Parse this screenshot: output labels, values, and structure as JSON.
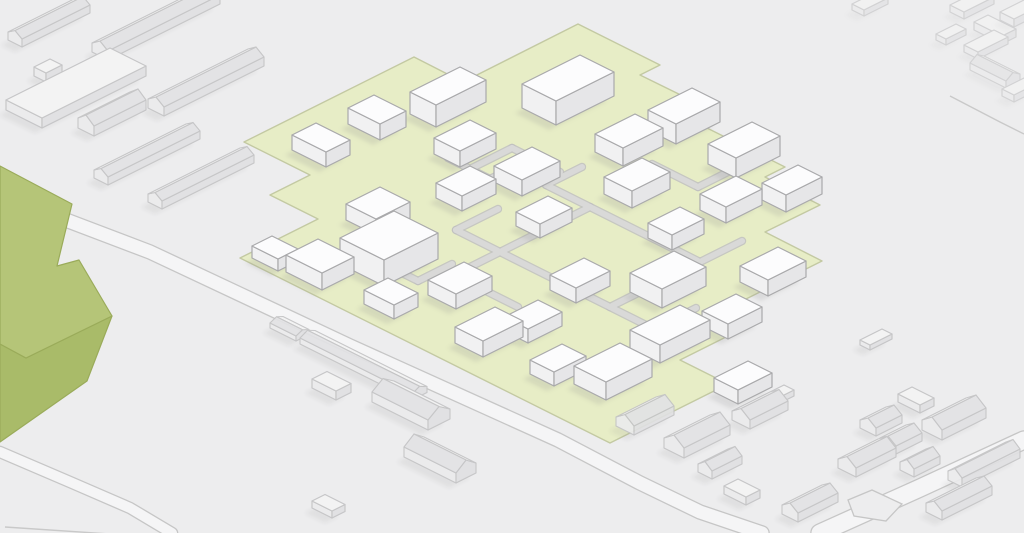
{
  "scene": {
    "width": 1024,
    "height": 533,
    "background": "#ededee",
    "description": "Isometric site-plan illustration: white buildings on a green development site surrounded by faded context buildings and roads"
  },
  "palette": {
    "site_building": {
      "top": "#fcfcfd",
      "left": "#f1f1f2",
      "right": "#e6e6e8",
      "stroke": "#a9a9ab",
      "shadow_opacity": 0.2
    },
    "context_building": {
      "top": "#f4f4f4",
      "left": "#ebebec",
      "right": "#e0e0e2",
      "roof_light": "#f2f2f2",
      "roof_dark": "#e2e2e4",
      "stroke": "#c2c2c4",
      "shadow_opacity": 0.14
    },
    "site_green": {
      "fill": "#e7edc6",
      "stroke": "#c3c9a2"
    },
    "footpath": {
      "casing": "#bfbfbf",
      "fill": "#d9d9d8"
    },
    "road": {
      "casing": "#c6c6c6",
      "fill": "#f5f5f6",
      "thin_line": "#c9c9c9"
    },
    "landmark": {
      "top": "#b5c578",
      "front": "#a9bb69",
      "stroke": "#9aab5a"
    },
    "shadow": "#8f8f8f"
  },
  "site": {
    "outline": [
      [
        578,
        24
      ],
      [
        660,
        65
      ],
      [
        640,
        75
      ],
      [
        695,
        102
      ],
      [
        675,
        112
      ],
      [
        785,
        167
      ],
      [
        765,
        177
      ],
      [
        820,
        205
      ],
      [
        765,
        232
      ],
      [
        822,
        261
      ],
      [
        732,
        306
      ],
      [
        760,
        320
      ],
      [
        680,
        360
      ],
      [
        728,
        384
      ],
      [
        658,
        419
      ],
      [
        610,
        443
      ],
      [
        240,
        258
      ],
      [
        318,
        219
      ],
      [
        270,
        195
      ],
      [
        310,
        175
      ],
      [
        244,
        142
      ],
      [
        414,
        57
      ],
      [
        463,
        82
      ]
    ],
    "buildings": [
      [
        292,
        150,
        34,
        24,
        15
      ],
      [
        348,
        124,
        32,
        26,
        16
      ],
      [
        410,
        114,
        26,
        50,
        22
      ],
      [
        522,
        108,
        34,
        58,
        24
      ],
      [
        595,
        152,
        28,
        40,
        18
      ],
      [
        648,
        130,
        28,
        44,
        20
      ],
      [
        708,
        164,
        28,
        44,
        20
      ],
      [
        762,
        200,
        24,
        36,
        17
      ],
      [
        434,
        154,
        26,
        36,
        16
      ],
      [
        436,
        198,
        26,
        34,
        15
      ],
      [
        494,
        182,
        28,
        38,
        16
      ],
      [
        516,
        226,
        24,
        32,
        14
      ],
      [
        604,
        194,
        28,
        38,
        17
      ],
      [
        648,
        238,
        24,
        32,
        15
      ],
      [
        700,
        210,
        26,
        36,
        16
      ],
      [
        740,
        282,
        28,
        38,
        16
      ],
      [
        702,
        326,
        26,
        34,
        15
      ],
      [
        346,
        220,
        30,
        34,
        16
      ],
      [
        340,
        264,
        44,
        54,
        26
      ],
      [
        286,
        272,
        36,
        32,
        17
      ],
      [
        252,
        258,
        26,
        20,
        12
      ],
      [
        428,
        295,
        28,
        36,
        15
      ],
      [
        364,
        304,
        30,
        24,
        14
      ],
      [
        455,
        343,
        28,
        40,
        16
      ],
      [
        504,
        331,
        24,
        34,
        14
      ],
      [
        530,
        374,
        24,
        32,
        14
      ],
      [
        574,
        384,
        32,
        46,
        18
      ],
      [
        550,
        290,
        26,
        34,
        15
      ],
      [
        630,
        292,
        32,
        44,
        19
      ],
      [
        630,
        348,
        30,
        50,
        18
      ],
      [
        714,
        392,
        24,
        34,
        14
      ]
    ],
    "footpaths": [
      [
        [
          500,
          252
        ],
        [
          590,
          207
        ]
      ],
      [
        [
          590,
          207
        ],
        [
          700,
          262
        ]
      ],
      [
        [
          700,
          262
        ],
        [
          610,
          307
        ]
      ],
      [
        [
          610,
          307
        ],
        [
          500,
          252
        ]
      ],
      [
        [
          590,
          207
        ],
        [
          546,
          185
        ]
      ],
      [
        [
          546,
          185
        ],
        [
          582,
          167
        ]
      ],
      [
        [
          700,
          262
        ],
        [
          742,
          241
        ]
      ],
      [
        [
          610,
          307
        ],
        [
          654,
          329
        ]
      ],
      [
        [
          500,
          252
        ],
        [
          456,
          230
        ]
      ],
      [
        [
          456,
          230
        ],
        [
          498,
          209
        ]
      ],
      [
        [
          500,
          252
        ],
        [
          454,
          275
        ]
      ],
      [
        [
          454,
          275
        ],
        [
          518,
          307
        ]
      ],
      [
        [
          448,
          158
        ],
        [
          490,
          179
        ]
      ],
      [
        [
          490,
          179
        ],
        [
          532,
          158
        ]
      ],
      [
        [
          532,
          158
        ],
        [
          512,
          148
        ]
      ],
      [
        [
          512,
          148
        ],
        [
          468,
          170
        ]
      ],
      [
        [
          532,
          158
        ],
        [
          560,
          172
        ]
      ],
      [
        [
          652,
          164
        ],
        [
          698,
          187
        ]
      ],
      [
        [
          698,
          187
        ],
        [
          740,
          166
        ]
      ],
      [
        [
          380,
          262
        ],
        [
          418,
          281
        ]
      ],
      [
        [
          418,
          281
        ],
        [
          452,
          264
        ]
      ],
      [
        [
          654,
          329
        ],
        [
          696,
          308
        ]
      ]
    ]
  },
  "landmark": {
    "top": [
      [
        0,
        166
      ],
      [
        72,
        204
      ],
      [
        57,
        266
      ],
      [
        79,
        260
      ],
      [
        112,
        316
      ],
      [
        26,
        358
      ],
      [
        0,
        344
      ]
    ],
    "front": [
      [
        0,
        344
      ],
      [
        26,
        358
      ],
      [
        112,
        316
      ],
      [
        87,
        381
      ],
      [
        0,
        442
      ]
    ]
  },
  "context_buildings": [
    [
      "g",
      "b",
      8,
      40,
      14,
      68,
      8,
      5
    ],
    [
      "b",
      "-",
      6,
      110,
      36,
      104,
      10,
      0
    ],
    [
      "g",
      "b",
      78,
      128,
      16,
      52,
      10,
      7
    ],
    [
      "b",
      "-",
      34,
      76,
      12,
      16,
      9,
      0
    ],
    [
      "g",
      "b",
      92,
      52,
      16,
      112,
      9,
      6
    ],
    [
      "g",
      "b",
      148,
      108,
      16,
      100,
      9,
      6
    ],
    [
      "g",
      "b",
      94,
      178,
      14,
      92,
      8,
      5
    ],
    [
      "g",
      "b",
      148,
      202,
      14,
      92,
      8,
      5
    ],
    [
      "g",
      "a",
      300,
      344,
      112,
      15,
      6,
      4
    ],
    [
      "g",
      "a",
      270,
      328,
      26,
      13,
      5,
      3
    ],
    [
      "b",
      "-",
      312,
      388,
      24,
      15,
      9,
      0
    ],
    [
      "g",
      "a",
      372,
      402,
      56,
      22,
      10,
      8
    ],
    [
      "g",
      "a",
      404,
      457,
      52,
      20,
      10,
      8
    ],
    [
      "b",
      "-",
      312,
      508,
      20,
      13,
      7,
      0
    ],
    [
      "g",
      "b",
      616,
      426,
      18,
      40,
      9,
      7
    ],
    [
      "g",
      "b",
      664,
      448,
      20,
      46,
      10,
      8
    ],
    [
      "b",
      "-",
      724,
      494,
      22,
      14,
      8,
      0
    ],
    [
      "g",
      "b",
      732,
      420,
      18,
      38,
      9,
      7
    ],
    [
      "b",
      "-",
      758,
      404,
      10,
      26,
      6,
      0
    ],
    [
      "g",
      "b",
      698,
      472,
      14,
      30,
      8,
      6
    ],
    [
      "g",
      "b",
      782,
      514,
      16,
      40,
      9,
      6
    ],
    [
      "g",
      "b",
      838,
      468,
      18,
      40,
      9,
      7
    ],
    [
      "g",
      "b",
      860,
      428,
      16,
      26,
      8,
      6
    ],
    [
      "g",
      "b",
      880,
      446,
      16,
      26,
      8,
      6
    ],
    [
      "b",
      "-",
      898,
      402,
      22,
      14,
      8,
      0
    ],
    [
      "g",
      "b",
      922,
      430,
      20,
      44,
      10,
      8
    ],
    [
      "g",
      "b",
      900,
      470,
      14,
      26,
      8,
      6
    ],
    [
      "g",
      "b",
      948,
      480,
      14,
      58,
      9,
      6
    ],
    [
      "g",
      "b",
      926,
      512,
      16,
      50,
      9,
      6
    ],
    [
      "b",
      "-",
      860,
      345,
      10,
      22,
      5,
      0
    ]
  ],
  "far_buildings": [
    [
      "b",
      "-",
      852,
      10,
      12,
      24,
      6,
      0
    ],
    [
      "b",
      "-",
      950,
      12,
      14,
      30,
      7,
      0
    ],
    [
      "b",
      "-",
      974,
      30,
      28,
      14,
      8,
      0
    ],
    [
      "b",
      "-",
      1000,
      20,
      14,
      36,
      8,
      0
    ],
    [
      "b",
      "-",
      964,
      52,
      14,
      30,
      7,
      0
    ],
    [
      "g",
      "a",
      970,
      70,
      36,
      14,
      7,
      5
    ],
    [
      "b",
      "-",
      1002,
      96,
      12,
      26,
      7,
      0
    ],
    [
      "b",
      "-",
      936,
      40,
      10,
      20,
      6,
      0
    ]
  ],
  "roads": {
    "strips": [
      {
        "pts": [
          [
            0,
            195
          ],
          [
            150,
            252
          ],
          [
            350,
            346
          ],
          [
            558,
            440
          ],
          [
            640,
            483
          ],
          [
            700,
            512
          ],
          [
            762,
            533
          ]
        ],
        "w": 13
      },
      {
        "pts": [
          [
            820,
            533
          ],
          [
            920,
            488
          ],
          [
            1024,
            440
          ]
        ],
        "w": 17
      },
      {
        "pts": [
          [
            0,
            452
          ],
          [
            70,
            482
          ],
          [
            130,
            508
          ],
          [
            172,
            533
          ]
        ],
        "w": 10
      }
    ],
    "thin_lines": [
      [
        [
          5,
          527
        ],
        [
          200,
          540
        ],
        [
          420,
          544
        ],
        [
          625,
          537
        ],
        [
          700,
          534
        ]
      ],
      [
        [
          950,
          96
        ],
        [
          1000,
          122
        ],
        [
          1024,
          134
        ]
      ]
    ],
    "island": [
      [
        848,
        500
      ],
      [
        872,
        490
      ],
      [
        902,
        504
      ],
      [
        886,
        521
      ],
      [
        854,
        516
      ]
    ]
  }
}
